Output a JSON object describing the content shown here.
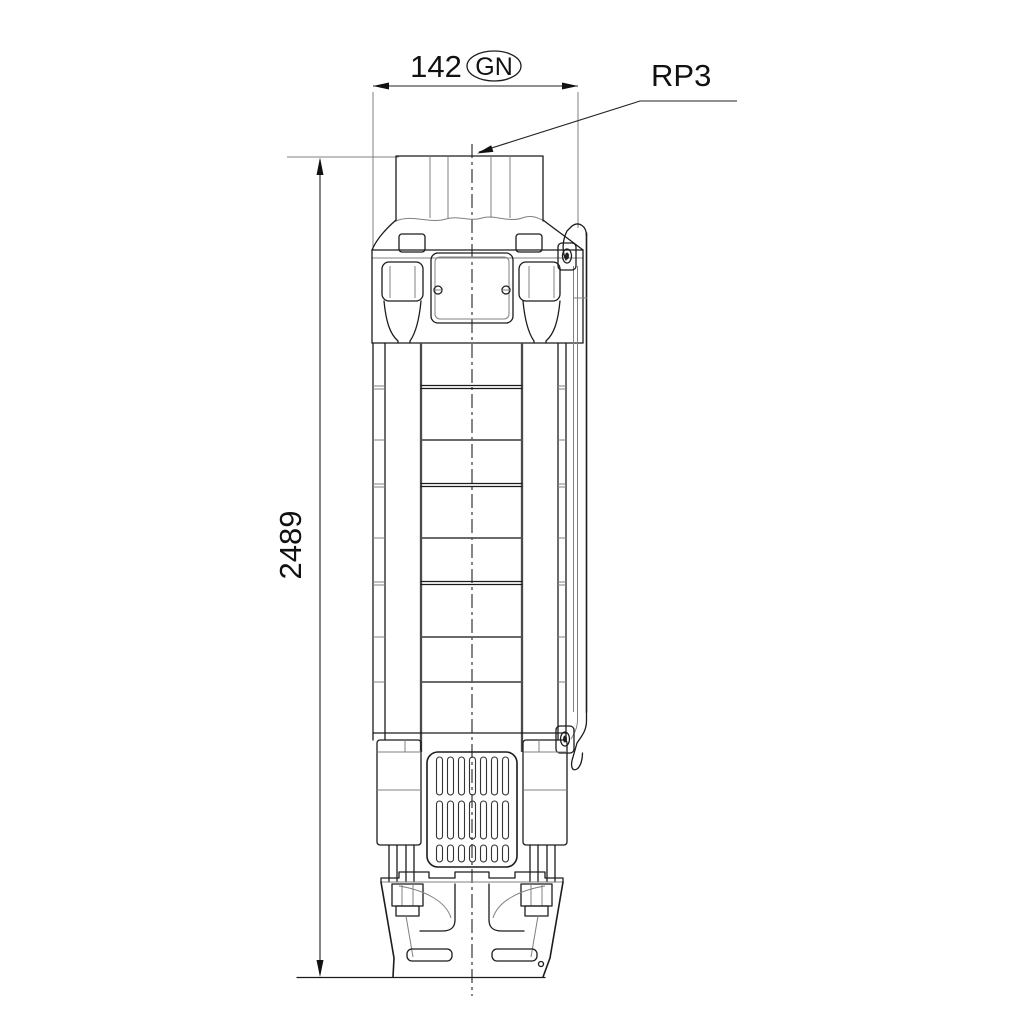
{
  "drawing": {
    "background_color": "#ffffff",
    "line_color": "#1c1c1c",
    "thin_line_color": "#808080",
    "dimensions": {
      "width": {
        "value": "142",
        "badge": "GN"
      },
      "height": {
        "value": "2489"
      }
    },
    "labels": {
      "connection": "RP3"
    }
  }
}
